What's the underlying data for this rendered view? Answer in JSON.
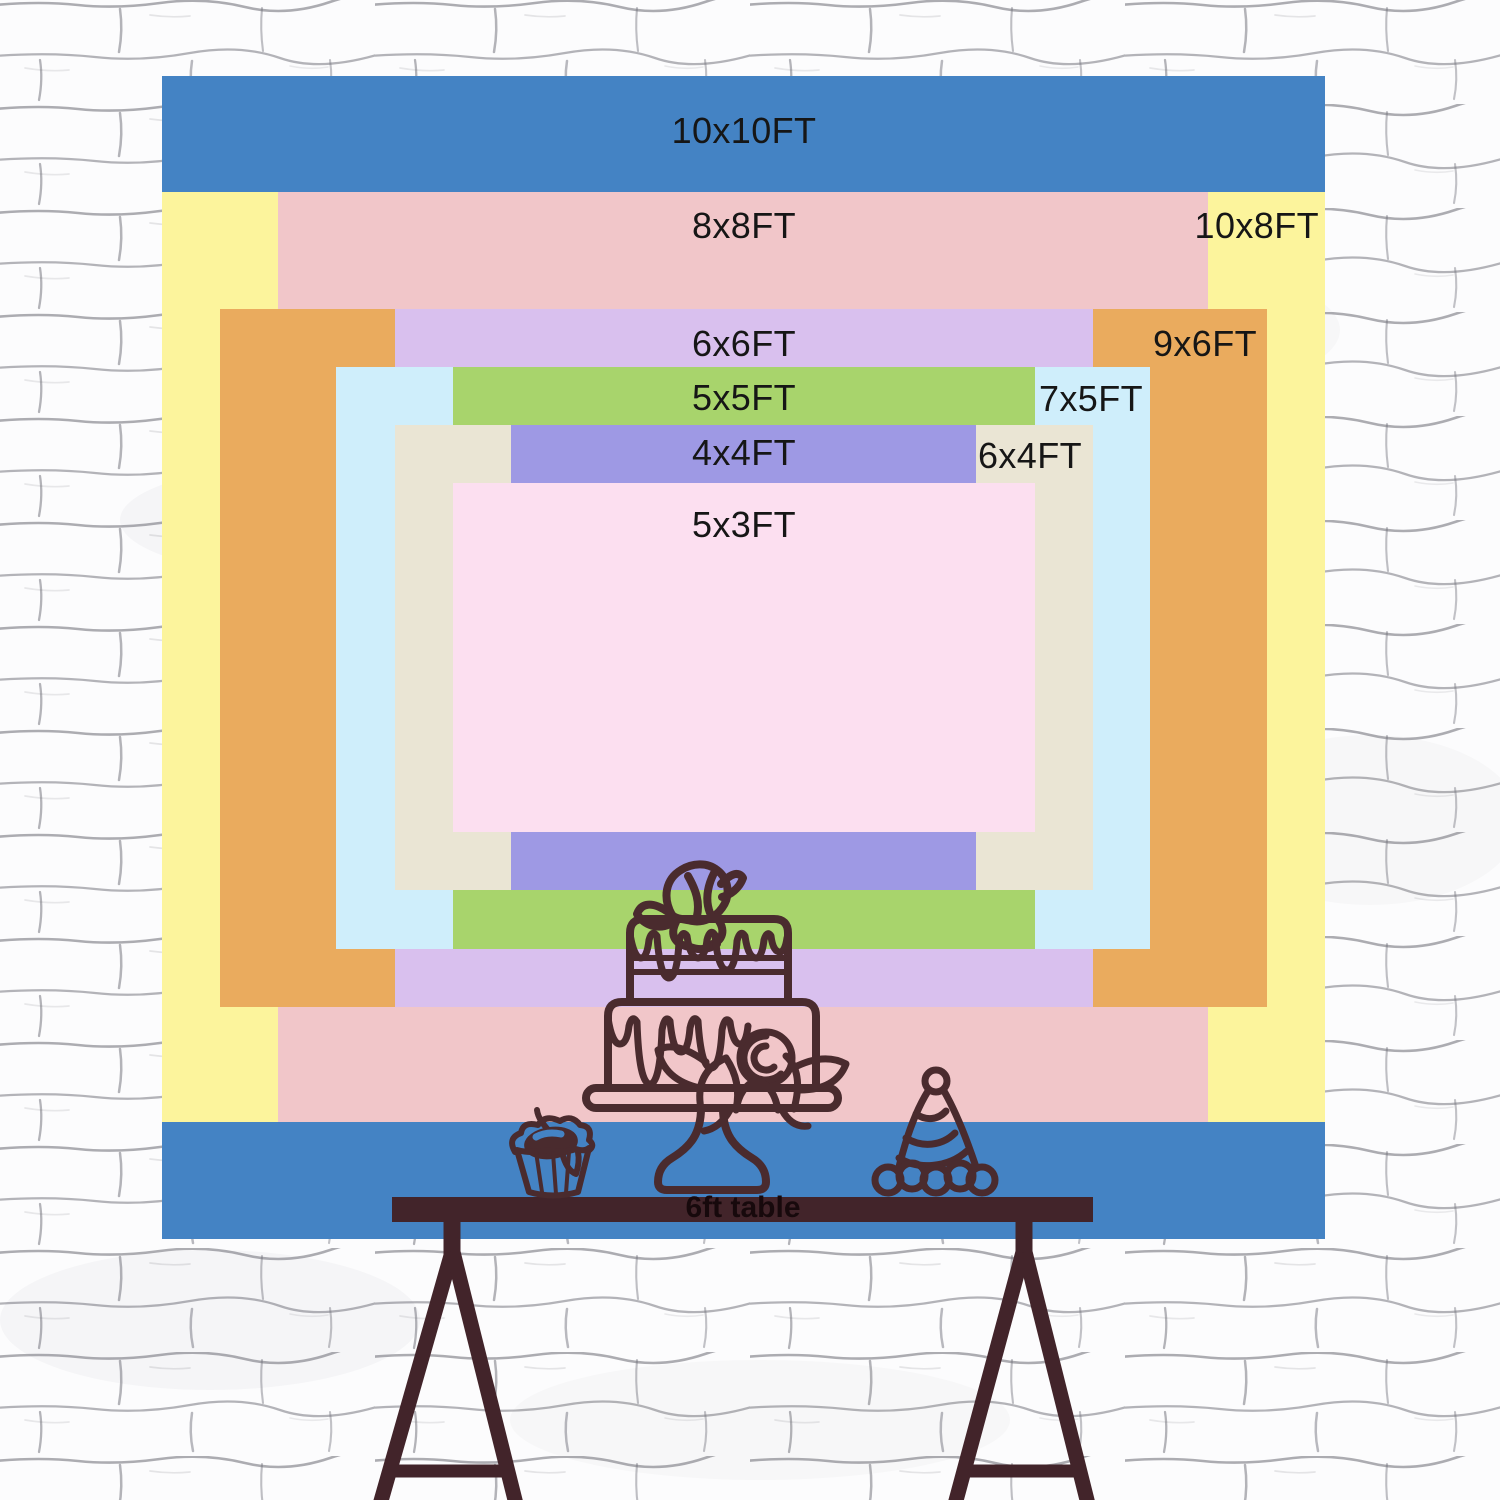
{
  "chart_data": {
    "type": "size-comparison",
    "title": "backdrop size chart",
    "unit": "FT",
    "px_per_ft": 116.3,
    "center_x": 743.5,
    "center_y": 657.5,
    "label_font_px": 36,
    "text_color": "#161616",
    "sizes": [
      {
        "id": "10x10",
        "label": "10x10FT",
        "width_ft": 10,
        "height_ft": 10,
        "color": "#4483c4",
        "label_pos": "top-center",
        "label_dy": 34
      },
      {
        "id": "10x8",
        "label": "10x8FT",
        "width_ft": 10,
        "height_ft": 8,
        "color": "#fcf49c",
        "label_pos": "top-right",
        "label_dy": 13,
        "label_dx": 6
      },
      {
        "id": "8x8",
        "label": "8x8FT",
        "width_ft": 8,
        "height_ft": 8,
        "color": "#f1c6c9",
        "label_pos": "top-center",
        "label_dy": 13
      },
      {
        "id": "9x6",
        "label": "9x6FT",
        "width_ft": 9,
        "height_ft": 6,
        "color": "#eaab5e",
        "label_pos": "top-right",
        "label_dy": 14,
        "label_dx": 10
      },
      {
        "id": "6x6",
        "label": "6x6FT",
        "width_ft": 6,
        "height_ft": 6,
        "color": "#d9c0ee",
        "label_pos": "top-center",
        "label_dy": 14
      },
      {
        "id": "7x5",
        "label": "7x5FT",
        "width_ft": 7,
        "height_ft": 5,
        "color": "#cfeefb",
        "label_pos": "top-right",
        "label_dy": 11,
        "label_dx": 8
      },
      {
        "id": "5x5",
        "label": "5x5FT",
        "width_ft": 5,
        "height_ft": 5,
        "color": "#a8d46c",
        "label_pos": "top-center",
        "label_dy": 10
      },
      {
        "id": "6x4",
        "label": "6x4FT",
        "width_ft": 6,
        "height_ft": 4,
        "color": "#eae5d4",
        "label_pos": "top-right",
        "label_dy": 10,
        "label_dx": 10
      },
      {
        "id": "4x4",
        "label": "4x4FT",
        "width_ft": 4,
        "height_ft": 4,
        "color": "#9e99e4",
        "label_pos": "top-center",
        "label_dy": 7
      },
      {
        "id": "5x3",
        "label": "5x3FT",
        "width_ft": 5,
        "height_ft": 3,
        "color": "#fcdff0",
        "label_pos": "top-center",
        "label_dy": 21
      }
    ]
  },
  "scene": {
    "table_label": "6ft table",
    "table_color": "#42242a",
    "line_color": "#4a2b2e",
    "table_label_color": "#17090c",
    "cherry_highlight": "#4483c4",
    "wall_line_color": "#696973",
    "wall_bg_color": "#fcfcfd"
  }
}
